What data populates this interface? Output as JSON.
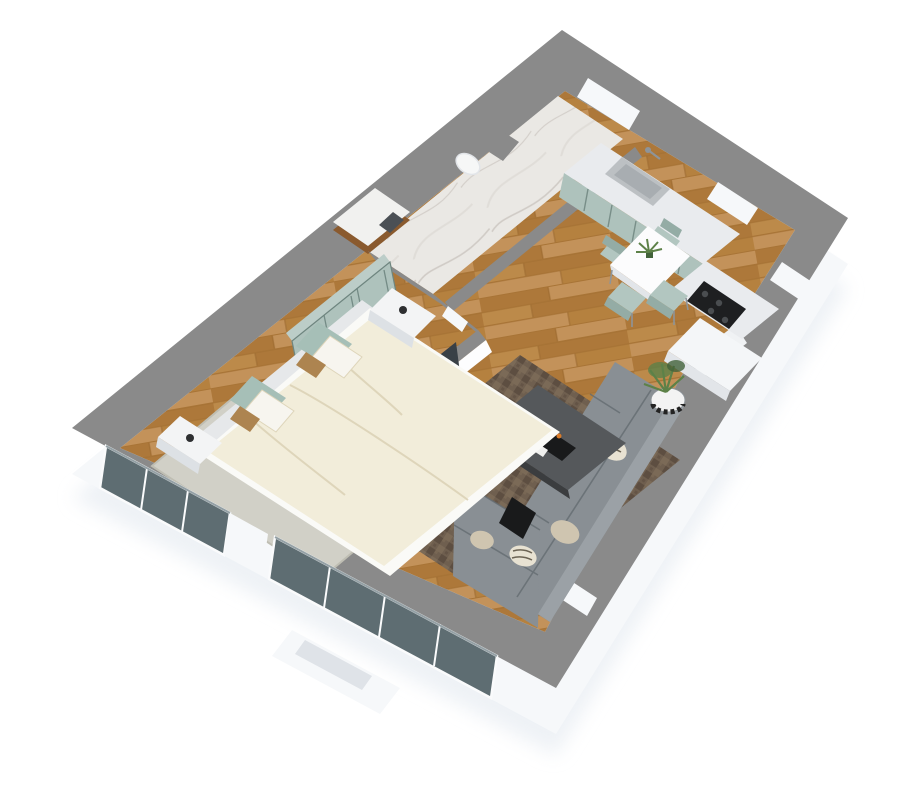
{
  "title": "3D isometric apartment floor plan render",
  "palette": {
    "background": "#ffffff",
    "shadow": "#e3e9f0",
    "wall_top": "#8a8a8a",
    "wall_top_light": "#9a9a9a",
    "wall_face": "#f6f8fa",
    "int_wall_face": "#fdfdfe",
    "wood_base": "#b5813f",
    "wood_mid": "#ad783a",
    "wood_dark": "#9c6a30",
    "wood_light": "#c3925a",
    "wood_pale": "#bc8a4a",
    "marble_base": "#eae8e4",
    "marble_vein": "#c9c4be",
    "marble_dark": "#d9d5d0",
    "sage": "#aec2bc",
    "sage_top": "#bccdc8",
    "sage_line": "#6e857f",
    "counter": "#e9ebee",
    "white_block": "#f4f6f8",
    "block_edge": "#e2e5e9",
    "steel": "#bcc0c3",
    "steel_dark": "#8e9499",
    "sink_inner": "#a8adb1",
    "cooktop": "#1e1f21",
    "burner": "#4a4d50",
    "table_white": "#fcfcfd",
    "chair": "#b2c6c0",
    "chair_dark": "#94aca5",
    "rug_living": "#6f5f4f",
    "rug_living_dark": "#594a3d",
    "rug_living_light": "#85725c",
    "sofa": "#898f94",
    "sofa_dark": "#71787e",
    "sofa_light": "#9ba1a6",
    "sofa_seam": "#646b71",
    "pillow_beige": "#cfc5b0",
    "pillow_zebra": "#e8e2d2",
    "zebra_line": "#6b6353",
    "coffee_top": "#55585b",
    "coffee_side": "#3b3d3f",
    "tray_black": "#191a1b",
    "candle_orange": "#d97b2a",
    "book_white": "#f0f0ee",
    "plant_green": "#5d8148",
    "plant_green_dark": "#42623a",
    "pot_white": "#f3f3f3",
    "pot_band": "#232323",
    "rug_bedroom": "#d1d0c7",
    "rug_bedroom_dark": "#bfbeb3",
    "duvet": "#f2edda",
    "duvet_shadow": "#ded5ba",
    "mattress": "#fafaf7",
    "headboard": "#e6e8ea",
    "cushion_sage": "#a6bfb7",
    "pillow_white": "#f7f5ef",
    "pillow_tan": "#ad8450",
    "nightstand": "#f3f4f5",
    "nightstand_shadow": "#dde1e5",
    "cup_dark": "#2e2f31",
    "tv_dark": "#394046",
    "art_orange": "#ad6a35",
    "art_blue": "#31495e",
    "dresser": "#f2f3f5",
    "vanity_wood": "#8a5a2e",
    "vanity_top": "#f1f1ef",
    "towel": "#4b5055",
    "toilet": "#f6f7f7",
    "glass": "#5e6d72",
    "glass_light": "#7b898e",
    "frame_white": "#fafbfc",
    "step_gray": "#dfe3e8"
  },
  "scene": {
    "view": "3d-top-down-isometric",
    "rooms": [
      {
        "name": "bathroom",
        "floor": "marble",
        "items": [
          "wood-vanity-sink",
          "towel",
          "toilet",
          "shower-partition",
          "bathroom-door-opening"
        ]
      },
      {
        "name": "entry-hall",
        "floor": "wood",
        "items": [
          "entry-door-opening"
        ]
      },
      {
        "name": "kitchen",
        "floor": "wood",
        "items": [
          "stainless-sink",
          "faucet",
          "sage-cabinet-run",
          "black-cooktop",
          "white-counter-block"
        ]
      },
      {
        "name": "dining-area",
        "floor": "wood",
        "items": [
          "white-square-table",
          "sage-chair",
          "sage-chair",
          "sage-chair",
          "sage-chair",
          "table-plant"
        ]
      },
      {
        "name": "living-room",
        "floor": "wood",
        "items": [
          "brown-area-rug",
          "gray-l-shaped-sofa",
          "zebra-pillows",
          "beige-pillows",
          "dark-coffee-table",
          "candles",
          "black-side-table",
          "large-potted-plant",
          "small-potted-plant",
          "tv",
          "white-tv-console",
          "wall-art"
        ]
      },
      {
        "name": "bedroom",
        "floor": "wood",
        "items": [
          "double-bed-cream-duvet",
          "sage-headboard-cushions",
          "white-pillows",
          "tan-pillows",
          "sage-wardrobe",
          "nightstand-with-cup",
          "nightstand-with-cup",
          "light-area-rug",
          "white-dresser"
        ]
      }
    ],
    "openings": [
      "entry-door-ne-wall",
      "bathroom-door",
      "bedroom-door",
      "ne-window",
      "se-window-east",
      "se-window-south",
      "sw-bedroom-window",
      "sw-glass-slider"
    ],
    "exterior": [
      "white-plinth-walls",
      "gray-wall-tops",
      "exterior-step"
    ]
  }
}
